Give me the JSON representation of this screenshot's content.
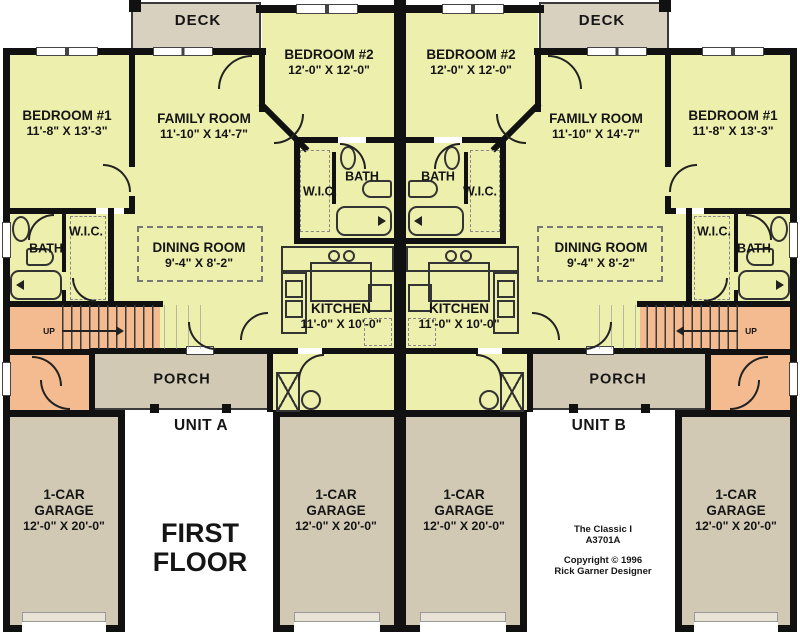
{
  "title": "FIRST FLOOR",
  "units": {
    "a": "UNIT A",
    "b": "UNIT B"
  },
  "rooms": {
    "deck": "DECK",
    "porch": "PORCH",
    "bath": "BATH",
    "wic": "W.I.C.",
    "up": "UP",
    "bedroom1": {
      "name": "BEDROOM #1",
      "dims": "11'-8\" X 13'-3\""
    },
    "bedroom2": {
      "name": "BEDROOM #2",
      "dims": "12'-0\" X 12'-0\""
    },
    "family_room": {
      "name": "FAMILY ROOM",
      "dims": "11'-10\" X 14'-7\""
    },
    "dining_room": {
      "name": "DINING ROOM",
      "dims": "9'-4\" X 8'-2\""
    },
    "kitchen": {
      "name": "KITCHEN",
      "dims": "11'-0\" X 10'-0\""
    },
    "garage": {
      "line1": "1-CAR",
      "line2": "GARAGE",
      "dims": "12'-0\" X 20'-0\""
    }
  },
  "title_block": {
    "plan_name": "The Classic I",
    "plan_number": "A3701A",
    "copyright": "Copyright ©  1996",
    "designer": "Rick Garner Designer"
  },
  "colors": {
    "room_fill": "#edefad",
    "deck_fill": "#d8d1c0",
    "garage_fill": "#d1c9b3",
    "stairs_fill": "#f3bb8f",
    "wall": "#111111"
  }
}
